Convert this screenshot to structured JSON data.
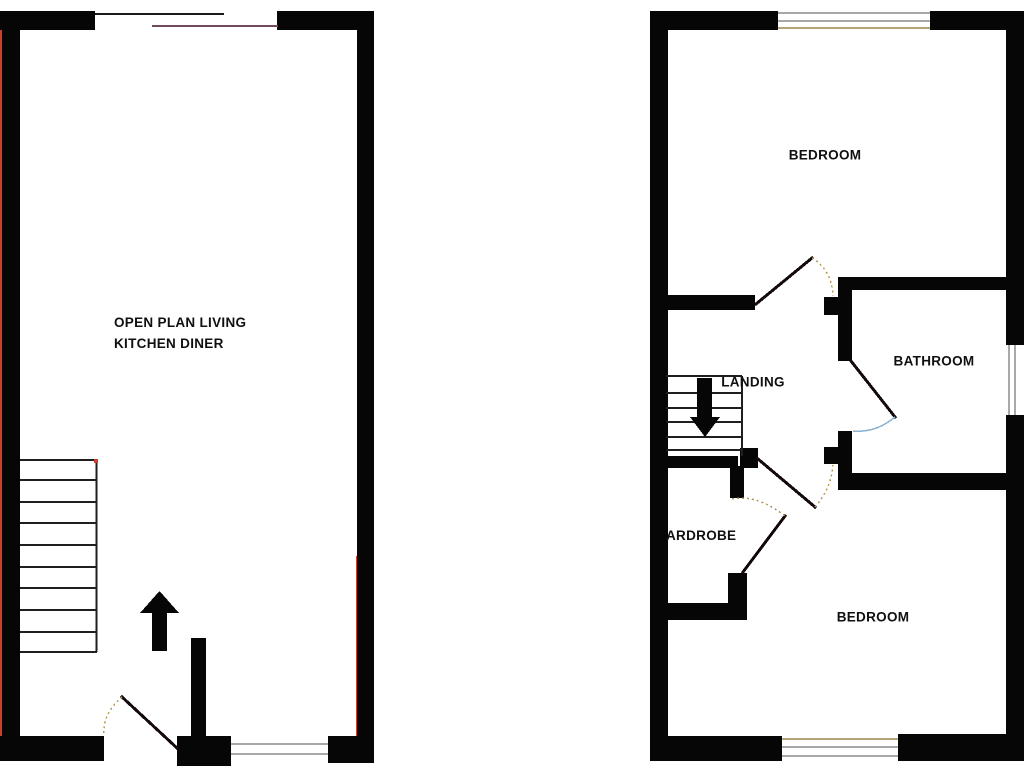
{
  "floorplan": {
    "floors": {
      "ground": {
        "living_label_line1": "OPEN PLAN LIVING",
        "living_label_line2": "KITCHEN DINER"
      },
      "first": {
        "bedroom_front_label": "BEDROOM",
        "bathroom_label": "BATHROOM",
        "landing_label": "LANDING",
        "wardrobe_label": "ARDROBE",
        "bedroom_back_label": "BEDROOM"
      }
    },
    "colors": {
      "wall": "#060606",
      "accent_red": "#c8402e",
      "accent_purple": "#74485f",
      "door_swing_tan": "#b49a5a",
      "door_swing_blue": "#8ab2d2",
      "window_gray": "#a8a8a8"
    }
  }
}
